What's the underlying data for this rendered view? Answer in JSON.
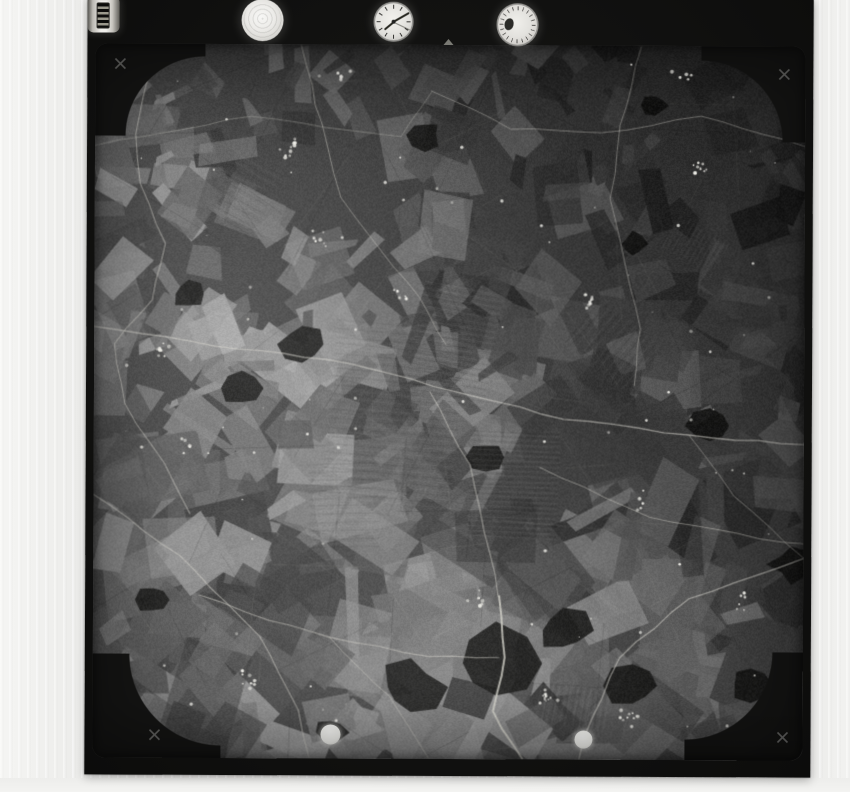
{
  "document": {
    "kind": "monochrome vertical aerial survey photograph, scanned print",
    "visible_text": "none"
  },
  "palette": {
    "paper": "#e9e8e6",
    "frame_black": "#111110",
    "film_base": "#454545",
    "wood_dark": "#161615",
    "road_light": "#d6d4cc",
    "speck_white": "#f0efe9",
    "dot_white": "#fbfbf8",
    "fiducial_gray": "#8d8d8b"
  },
  "instrument_panel": {
    "items": [
      {
        "name": "spirit-level-disc"
      },
      {
        "name": "mission-clock"
      },
      {
        "name": "altimeter-dial"
      },
      {
        "name": "frame-counter-drum"
      }
    ],
    "clock": {
      "hour_angle_deg": 140,
      "minute_angle_deg": -30,
      "second_angle_deg": 25
    }
  },
  "fiducials": {
    "corner_crosses": 4,
    "top_edge_notch": 1
  },
  "registration_dots": {
    "count": 2
  },
  "aerial": {
    "seed": 9,
    "fields": {
      "count": 560
    },
    "woods": [
      [
        403,
        618,
        52
      ],
      [
        318,
        642,
        34
      ],
      [
        470,
        585,
        30
      ],
      [
        208,
        300,
        24
      ],
      [
        148,
        344,
        20
      ],
      [
        392,
        412,
        18
      ],
      [
        616,
        380,
        24
      ],
      [
        698,
        518,
        22
      ],
      [
        94,
        250,
        18
      ],
      [
        538,
        198,
        14
      ],
      [
        658,
        638,
        20
      ],
      [
        238,
        688,
        18
      ],
      [
        540,
        640,
        26
      ],
      [
        60,
        556,
        16
      ],
      [
        330,
        90,
        18
      ],
      [
        560,
        60,
        14
      ]
    ],
    "stripe_patches": [
      [
        300,
        370,
        180,
        130,
        95
      ],
      [
        360,
        300,
        120,
        80,
        100
      ],
      [
        420,
        440,
        110,
        90,
        92
      ],
      [
        250,
        460,
        90,
        70,
        88
      ],
      [
        520,
        300,
        80,
        60,
        40
      ],
      [
        150,
        150,
        70,
        50,
        120
      ],
      [
        600,
        200,
        60,
        40,
        30
      ],
      [
        480,
        660,
        70,
        40,
        10
      ]
    ],
    "roads": [
      {
        "p": [
          [
            0,
            283
          ],
          [
            120,
            301
          ],
          [
            255,
            318
          ],
          [
            360,
            347
          ],
          [
            470,
            373
          ],
          [
            595,
            389
          ],
          [
            710,
            399
          ]
        ],
        "w": 1.4,
        "a": 0.55
      },
      {
        "p": [
          [
            52,
            36
          ],
          [
            40,
            90
          ],
          [
            46,
            140
          ],
          [
            70,
            200
          ],
          [
            58,
            256
          ],
          [
            20,
            300
          ],
          [
            30,
            360
          ],
          [
            70,
            420
          ],
          [
            96,
            470
          ]
        ],
        "w": 1.1,
        "a": 0.5
      },
      {
        "p": [
          [
            206,
            1
          ],
          [
            226,
            80
          ],
          [
            246,
            153
          ],
          [
            286,
            205
          ],
          [
            326,
            253
          ],
          [
            352,
            300
          ]
        ],
        "w": 1.0,
        "a": 0.45
      },
      {
        "p": [
          [
            336,
            46
          ],
          [
            416,
            83
          ],
          [
            506,
            88
          ],
          [
            606,
            70
          ],
          [
            710,
            100
          ]
        ],
        "w": 1.0,
        "a": 0.4
      },
      {
        "p": [
          [
            546,
            1
          ],
          [
            526,
            80
          ],
          [
            516,
            153
          ],
          [
            532,
            220
          ],
          [
            546,
            283
          ],
          [
            540,
            340
          ]
        ],
        "w": 1.0,
        "a": 0.4
      },
      {
        "p": [
          [
            406,
            551
          ],
          [
            412,
            612
          ],
          [
            400,
            666
          ],
          [
            420,
            700
          ],
          [
            430,
            713
          ]
        ],
        "w": 2.0,
        "a": 0.8
      },
      {
        "p": [
          [
            106,
            551
          ],
          [
            176,
            576
          ],
          [
            236,
            592
          ],
          [
            336,
            612
          ],
          [
            406,
            612
          ]
        ],
        "w": 1.2,
        "a": 0.5
      },
      {
        "p": [
          [
            0,
            451
          ],
          [
            86,
            512
          ],
          [
            166,
            592
          ],
          [
            206,
            666
          ],
          [
            216,
            713
          ]
        ],
        "w": 1.2,
        "a": 0.5
      },
      {
        "p": [
          [
            710,
            512
          ],
          [
            596,
            552
          ],
          [
            526,
            612
          ],
          [
            492,
            692
          ],
          [
            486,
            713
          ]
        ],
        "w": 1.3,
        "a": 0.55
      },
      {
        "p": [
          [
            446,
            422
          ],
          [
            556,
            472
          ],
          [
            666,
            492
          ],
          [
            710,
            498
          ]
        ],
        "w": 1.0,
        "a": 0.45
      },
      {
        "p": [
          [
            0,
            102
          ],
          [
            156,
            72
          ],
          [
            306,
            92
          ],
          [
            336,
            46
          ]
        ],
        "w": 0.9,
        "a": 0.35
      },
      {
        "p": [
          [
            336,
            347
          ],
          [
            376,
            420
          ],
          [
            406,
            551
          ]
        ],
        "w": 1.2,
        "a": 0.5
      },
      {
        "p": [
          [
            595,
            389
          ],
          [
            640,
            450
          ],
          [
            710,
            512
          ]
        ],
        "w": 1.0,
        "a": 0.4
      },
      {
        "p": [
          [
            236,
            592
          ],
          [
            296,
            652
          ],
          [
            336,
            713
          ]
        ],
        "w": 1.0,
        "a": 0.45
      }
    ],
    "villages": [
      [
        196,
        103
      ],
      [
        226,
        193
      ],
      [
        456,
        653
      ],
      [
        536,
        673
      ],
      [
        306,
        253
      ],
      [
        96,
        403
      ],
      [
        546,
        453
      ],
      [
        386,
        553
      ],
      [
        606,
        123
      ],
      [
        156,
        633
      ],
      [
        496,
        258
      ],
      [
        648,
        558
      ],
      [
        66,
        306
      ],
      [
        246,
        33
      ],
      [
        586,
        33
      ]
    ]
  }
}
